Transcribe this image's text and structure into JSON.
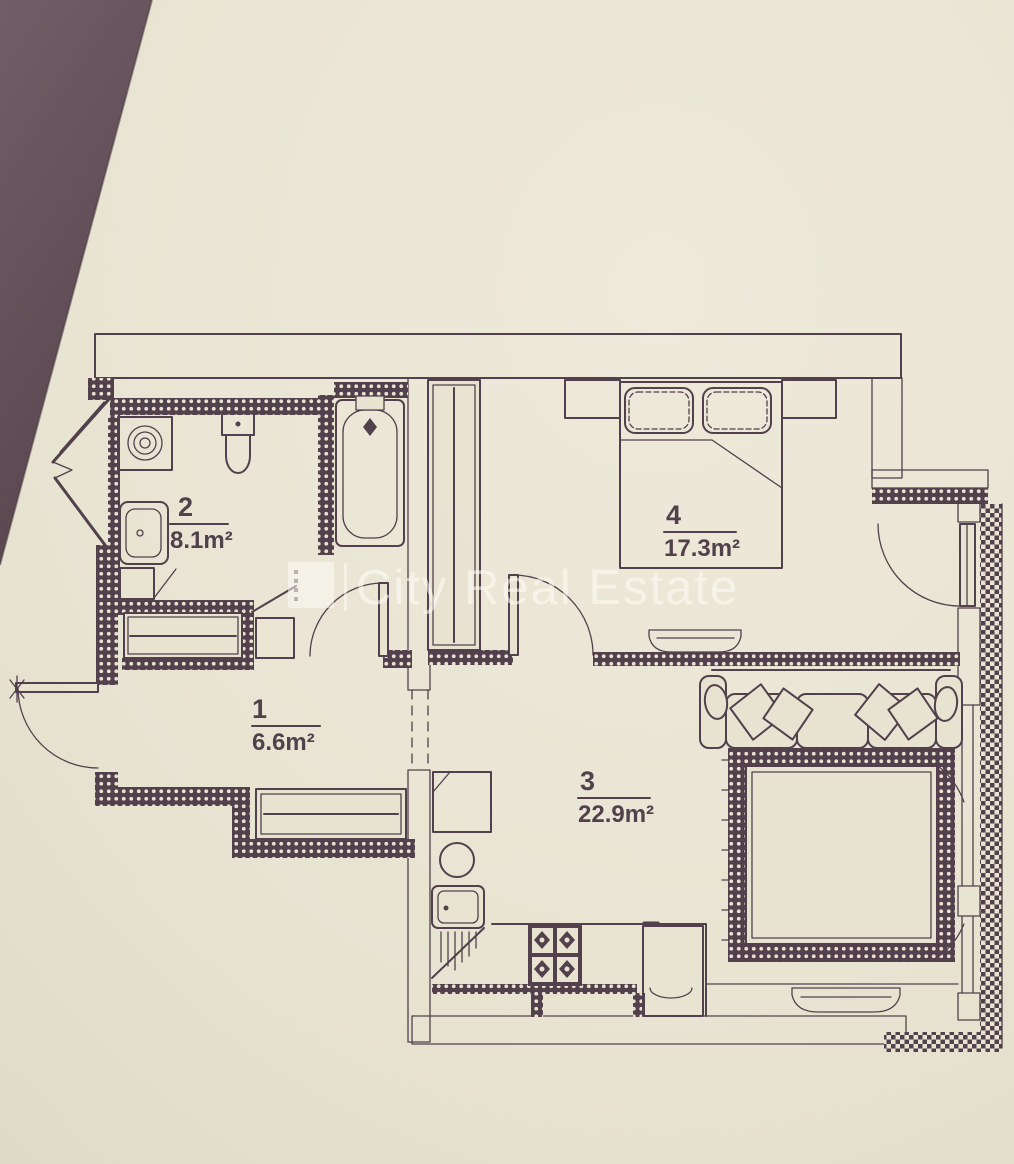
{
  "document": {
    "kind": "apartment floor plan photo",
    "colors": {
      "paper": "#e8e3d1",
      "ink": "#483643",
      "photo_shadow_top": "#6a5560",
      "photo_shadow_bottom": "#4e3b46",
      "watermark": "rgba(255,255,250,0.55)"
    }
  },
  "watermark": {
    "text": "City Real Estate",
    "logo": "city-real-estate-logo",
    "divider": "|"
  },
  "rooms": [
    {
      "number": "1",
      "area": "6.6m²",
      "name": "hallway"
    },
    {
      "number": "2",
      "area": "8.1m²",
      "name": "bathroom"
    },
    {
      "number": "3",
      "area": "22.9m²",
      "name": "living-room-kitchen"
    },
    {
      "number": "4",
      "area": "17.3m²",
      "name": "bedroom"
    }
  ],
  "fixtures": [
    {
      "icon": "washing-machine-icon",
      "room": "2"
    },
    {
      "icon": "toilet-icon",
      "room": "2"
    },
    {
      "icon": "washbasin-icon",
      "room": "2"
    },
    {
      "icon": "bathtub-icon",
      "room": "2"
    },
    {
      "icon": "laundry-basket-icon",
      "room": "2"
    },
    {
      "icon": "mirror-cabinet-icon",
      "room": "1"
    },
    {
      "icon": "entry-door-icon",
      "room": "1"
    },
    {
      "icon": "sliding-wardrobe-icon",
      "room": "1"
    },
    {
      "icon": "wardrobe-icon",
      "room": "4"
    },
    {
      "icon": "double-bed-icon",
      "room": "4"
    },
    {
      "icon": "nightstand-icon",
      "room": "4"
    },
    {
      "icon": "radiator-icon",
      "room": "4"
    },
    {
      "icon": "balcony-door-icon",
      "room": "4"
    },
    {
      "icon": "sofa-icon",
      "room": "3"
    },
    {
      "icon": "rug-icon",
      "room": "3"
    },
    {
      "icon": "radiator-icon",
      "room": "3"
    },
    {
      "icon": "fridge-icon",
      "room": "3"
    },
    {
      "icon": "hob-icon",
      "room": "3"
    },
    {
      "icon": "kitchen-sink-icon",
      "room": "3"
    },
    {
      "icon": "stove-icon",
      "room": "3"
    },
    {
      "icon": "kitchen-appliance-icon",
      "room": "3"
    }
  ]
}
